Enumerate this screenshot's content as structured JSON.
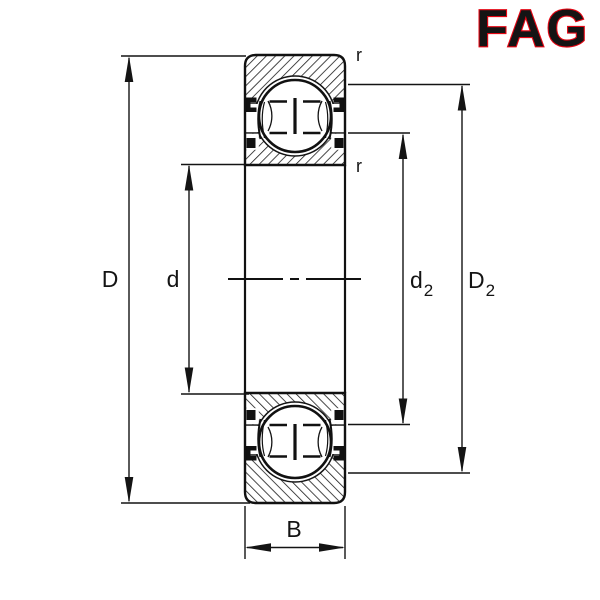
{
  "brand": {
    "name": "FAG",
    "color": "#E30613"
  },
  "labels": {
    "outer_diameter": "D",
    "bore_diameter": "d",
    "shoulder_inner": {
      "base": "d",
      "sub": "2"
    },
    "shoulder_outer": {
      "base": "D",
      "sub": "2"
    },
    "width": "B",
    "chamfer_outer": "r",
    "chamfer_inner": "r"
  }
}
